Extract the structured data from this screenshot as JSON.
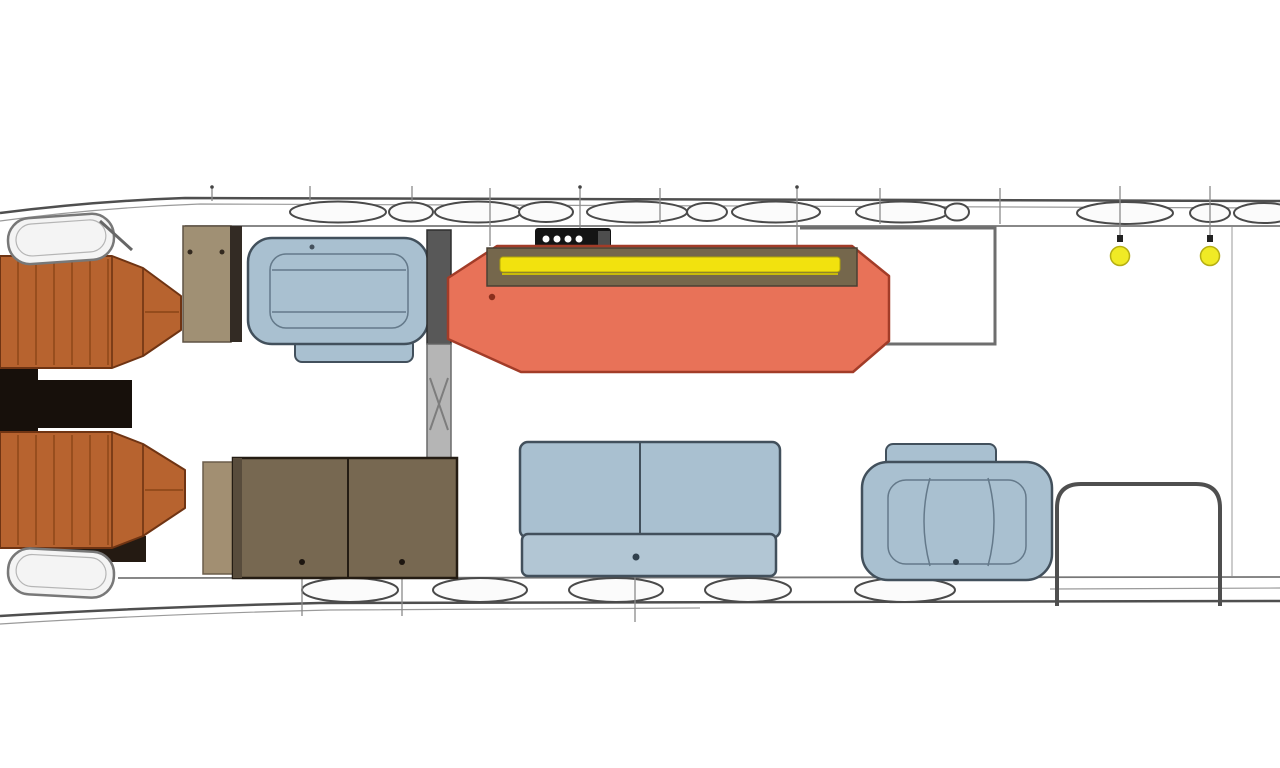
{
  "meta": {
    "title": "Yacht flybridge deck floor plan",
    "type": "floor-plan-diagram",
    "orientation": "bow-left-stern-right",
    "canvas": {
      "width": 1280,
      "height": 768
    },
    "visible_text": "none"
  },
  "colors": {
    "background": "#ffffff",
    "hull_line": "#4f4f4f",
    "oval_white": "#fbfbfb",
    "pad_white": "#f4f4f4",
    "seat_copper": "#b7632f",
    "seat_copper_dark": "#6f3413",
    "console_black": "#17100b",
    "under_seat_dark": "#241a12",
    "cabinet_tan": "#a09074",
    "wall_dark": "#332b24",
    "sofa_blue": "#a9c0d0",
    "sofa_blue_light": "#b2c6d4",
    "sofa_stroke": "#42505c",
    "sunpad_coral": "#e87258",
    "sunpad_stroke": "#a23c28",
    "counter_band": "#75674c",
    "accent_yellow": "#f2e20e",
    "table_brown": "#776851",
    "table_edge_dark": "#584c3c",
    "table_tan": "#a28f72",
    "grill_black": "#141414",
    "grill_knob": "#4d4d4d",
    "column_upper": "#585858",
    "column_lower": "#b5b5b5",
    "deck_light_yellow": "#f0ea25",
    "detail_dot_dark": "#30404d",
    "table_dot": "#1d1610",
    "seat_red_dot": "#8a2f1d",
    "fitting_dark": "#222222"
  },
  "elements": [
    {
      "id": "port-helm-seat",
      "label": "Copper helm seat (forward, upper)",
      "color_key": "seat_copper"
    },
    {
      "id": "starboard-helm-seat",
      "label": "Copper helm seat (forward, lower)",
      "color_key": "seat_copper"
    },
    {
      "id": "helm-console",
      "label": "Black console between helm seats",
      "color_key": "console_black"
    },
    {
      "id": "bow-pad-upper",
      "label": "White bolster pad, upper bow corner",
      "color_key": "pad_white"
    },
    {
      "id": "bow-pad-lower",
      "label": "White bolster pad, lower bow corner",
      "color_key": "pad_white"
    },
    {
      "id": "bar-cabinet",
      "label": "Tan cabinet with two fittings",
      "color_key": "cabinet_tan"
    },
    {
      "id": "forward-sofa",
      "label": "Blue loveseat sofa (upper left)",
      "color_key": "sofa_blue"
    },
    {
      "id": "mast-column",
      "label": "Gray structural column with cross brace",
      "color_key": "column_lower"
    },
    {
      "id": "grill",
      "label": "Grill unit with four burners",
      "color_key": "grill_black"
    },
    {
      "id": "sunpad-lounge",
      "label": "Coral sunpad lounge with counter band and yellow rail",
      "color_key": "sunpad_coral"
    },
    {
      "id": "wet-bar-counter",
      "label": "Counter outline aft of sunpad",
      "color_key": "hull_line"
    },
    {
      "id": "dinette-table",
      "label": "Brown two-leaf table with legs",
      "color_key": "table_brown"
    },
    {
      "id": "aft-bench-sofa",
      "label": "Blue two-seat bench sofa (lower middle)",
      "color_key": "sofa_blue"
    },
    {
      "id": "aft-armchair",
      "label": "Blue armchair with headrest (lower right)",
      "color_key": "sofa_blue"
    },
    {
      "id": "aft-stairs",
      "label": "Rounded staircase opening outline (stern)",
      "color_key": "hull_line"
    },
    {
      "id": "deck-lights",
      "label": "Two yellow deck lights on stern rail",
      "color_key": "deck_light_yellow"
    },
    {
      "id": "gunwale-bolsters",
      "label": "White oval bolsters along both gunwales",
      "color_key": "oval_white"
    }
  ],
  "counts": {
    "deck_lights": 2,
    "grill_burners": 4,
    "table_legs": 2,
    "top_ovals": 12,
    "bottom_ovals": 5
  }
}
